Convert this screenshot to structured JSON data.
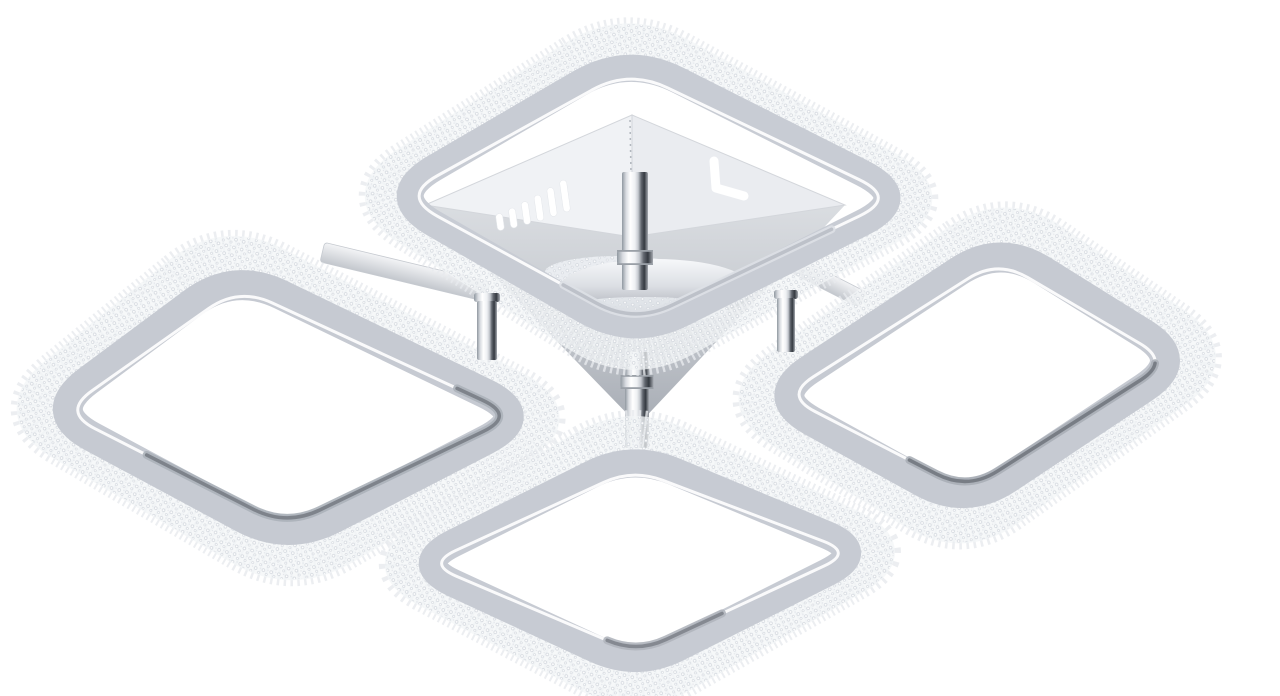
{
  "scene": {
    "type": "product-photo",
    "description": "Chrome modern LED ceiling lamp with four rounded-square rings trimmed with clear crystal beading, arranged in a diamond layout around a square chrome canopy with vent slots and a central chrome rod, photographed on a pure white background",
    "background_color": "#ffffff"
  },
  "palette": {
    "background": "#ffffff",
    "crystal_base": "#f3f5f7",
    "crystal_spike": "#e7eaee",
    "bead_fill": "#ffffff",
    "bead_stroke": "#cfd4db",
    "bead_small": "#e2e5ea",
    "inner_rim": "#ffffff",
    "face_left": "#f0f2f5",
    "face_right": "#eaecf0",
    "face_edge": "#d3d6db",
    "seam": "#b3b8bf",
    "slot_fill": "#ffffff",
    "slot_edge": "#e3e6ea",
    "dome_rim": "#959aa1",
    "collar_line": "#9aa0a7",
    "patch_base": "#eaedf1",
    "arm_edge": "#c6cad0",
    "chrome_stops": [
      [
        "0",
        "#9098a0"
      ],
      [
        "0.16",
        "#d9dce1"
      ],
      [
        "0.32",
        "#ffffff"
      ],
      [
        "0.5",
        "#eef0f3"
      ],
      [
        "0.62",
        "#c7cbd1"
      ],
      [
        "0.74",
        "#62676f"
      ],
      [
        "0.86",
        "#343940"
      ],
      [
        "1",
        "#a6aab1"
      ]
    ],
    "dome_stops": [
      [
        "0",
        "#f7f8fa"
      ],
      [
        "0.45",
        "#dcdfe4"
      ],
      [
        "0.75",
        "#b9bdc4"
      ],
      [
        "1",
        "#8f949b"
      ]
    ],
    "tray_stops": [
      [
        "0",
        "#dadde1"
      ],
      [
        "0.55",
        "#c3c7cd"
      ],
      [
        "1",
        "#a7acb4"
      ]
    ],
    "arm_stops": [
      [
        "0",
        "#f3f4f6"
      ],
      [
        "1",
        "#c3c7cd"
      ]
    ]
  },
  "lamp": {
    "rings": [
      {
        "id": "top",
        "corners": [
          [
            628,
            55
          ],
          [
            912,
            198
          ],
          [
            633,
            338
          ],
          [
            386,
            196
          ]
        ],
        "radius": 56,
        "gray_width": 27,
        "crystal_width": 34,
        "gray_color": "#c8ccd4",
        "accent": {
          "start": 0.36,
          "end": 0.64,
          "outer": "#dde0e6",
          "core": "#b6bbc3"
        }
      },
      {
        "id": "left",
        "corners": [
          [
            234,
            272
          ],
          [
            532,
            416
          ],
          [
            288,
            542
          ],
          [
            46,
            412
          ]
        ],
        "radius": 52,
        "gray_width": 30,
        "crystal_width": 38,
        "gray_color": "#c6cad2",
        "accent": {
          "start": 0.28,
          "end": 0.74,
          "outer": "#abb1b9",
          "core": "#747981"
        }
      },
      {
        "id": "right",
        "corners": [
          [
            1000,
            244
          ],
          [
            1186,
            360
          ],
          [
            966,
            506
          ],
          [
            768,
            397
          ]
        ],
        "radius": 50,
        "gray_width": 30,
        "crystal_width": 38,
        "gray_color": "#c6cad2",
        "accent": {
          "start": 0.26,
          "end": 0.6,
          "outer": "#a9aeb6",
          "core": "#6e737b"
        }
      },
      {
        "id": "bottom",
        "corners": [
          [
            632,
            454
          ],
          [
            868,
            552
          ],
          [
            637,
            668
          ],
          [
            412,
            564
          ]
        ],
        "radius": 46,
        "gray_width": 28,
        "crystal_width": 36,
        "gray_color": "#c7cbd3",
        "accent": {
          "start": 0.44,
          "end": 0.58,
          "outer": "#b0b5bd",
          "core": "#7b8088"
        }
      }
    ],
    "canopy": {
      "tray": [
        [
          425,
          205
        ],
        [
          632,
          237
        ],
        [
          845,
          205
        ],
        [
          638,
          425
        ]
      ],
      "face_left": [
        [
          632,
          115
        ],
        [
          425,
          205
        ],
        [
          632,
          237
        ]
      ],
      "face_right": [
        [
          632,
          115
        ],
        [
          845,
          205
        ],
        [
          632,
          237
        ]
      ],
      "seam": {
        "x1": 630,
        "y1": 120,
        "x2": 632,
        "y2": 232
      },
      "slots": {
        "width": 7,
        "tilt": -8,
        "items": [
          [
            500,
            222,
            17
          ],
          [
            513,
            218,
            20
          ],
          [
            526,
            213,
            23
          ],
          [
            539,
            208,
            26
          ],
          [
            552,
            202,
            29
          ],
          [
            565,
            196,
            32
          ]
        ]
      },
      "jslot": {
        "points": [
          [
            714,
            161
          ],
          [
            716,
            188
          ],
          [
            744,
            196
          ]
        ],
        "stroke_width": 9
      },
      "dome": {
        "cx": 656,
        "cy": 289,
        "rx": 97,
        "ry": 30
      },
      "patches": [
        {
          "cx": 617,
          "cy": 272,
          "rx": 72,
          "ry": 16
        },
        {
          "cx": 643,
          "cy": 310,
          "rx": 85,
          "ry": 13
        }
      ],
      "upper_post": {
        "x": 635,
        "top": 172,
        "bottom": 290,
        "width": 26,
        "collar_y": 250,
        "collar_h": 15,
        "collar_w": 36
      },
      "lower_post": {
        "x": 637,
        "top": 352,
        "bottom": 448,
        "width": 24,
        "collar_y": 375,
        "collar_h": 14,
        "collar_w": 33
      }
    },
    "arms": [
      {
        "cx": 405,
        "cy": 272,
        "w": 170,
        "h": 20,
        "angle": 13.5
      },
      {
        "cx": 820,
        "cy": 278,
        "w": 95,
        "h": 17,
        "angle": 27
      }
    ],
    "standoffs": [
      {
        "x": 487,
        "top": 295,
        "bottom": 360,
        "w": 20,
        "cap_w": 26,
        "cap_h": 9
      },
      {
        "x": 786,
        "top": 292,
        "bottom": 352,
        "w": 18,
        "cap_w": 24,
        "cap_h": 9
      }
    ]
  }
}
